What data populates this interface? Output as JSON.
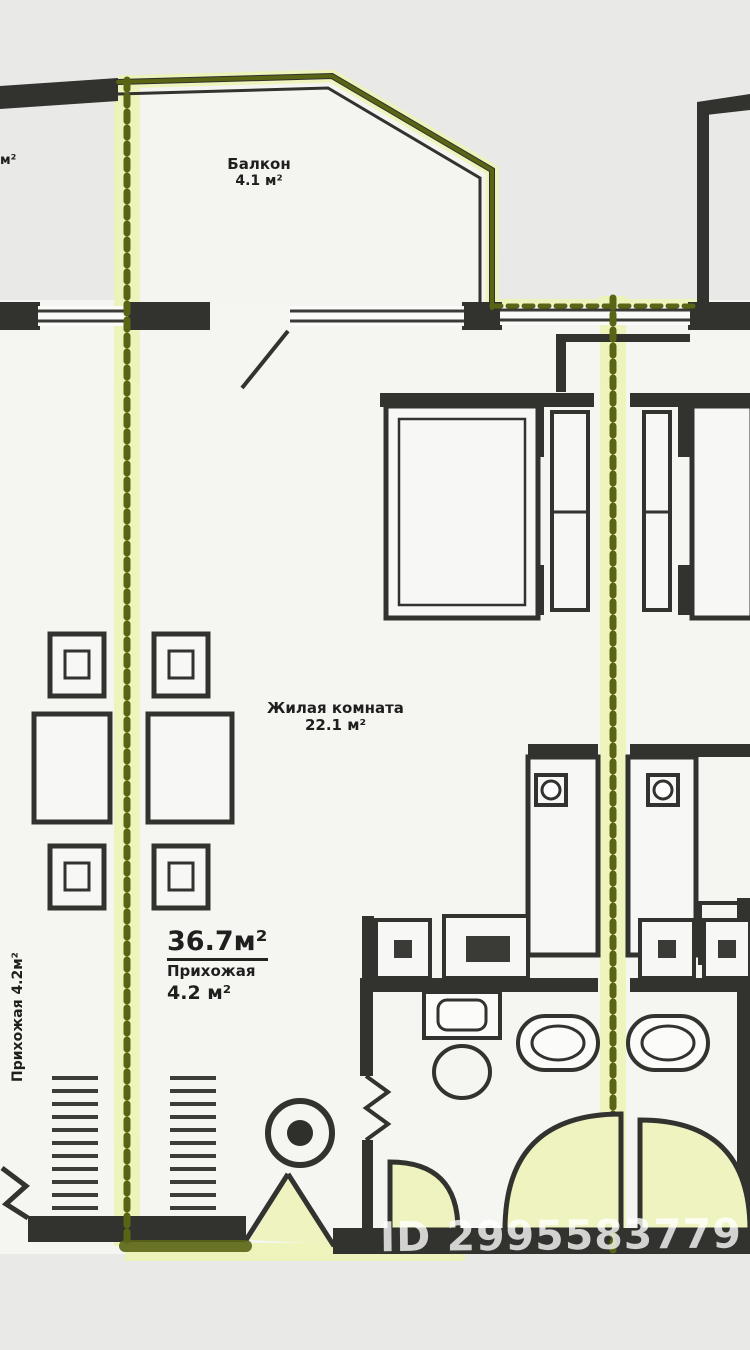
{
  "floor_plan": {
    "balcony": {
      "label": "Балкон",
      "area": "4.1 м²"
    },
    "living_room": {
      "label": "Жилая комната",
      "area": "22.1 м²"
    },
    "summary": {
      "total_area": "36.7м²",
      "room": "Прихожая",
      "room_area": "4.2 м²"
    },
    "left_flat_label": "Прихожая 4.2м²",
    "edge_label_fragment": "м²",
    "watermark": "ID 2995583779",
    "colors": {
      "background": "#e9e9e7",
      "room_fill": "#f5f5f2",
      "wall": "#32322e",
      "highlight_core": "#5a6415",
      "highlight_glow": "#eef3b6",
      "door_swing_fill": "#eff3bf"
    }
  }
}
